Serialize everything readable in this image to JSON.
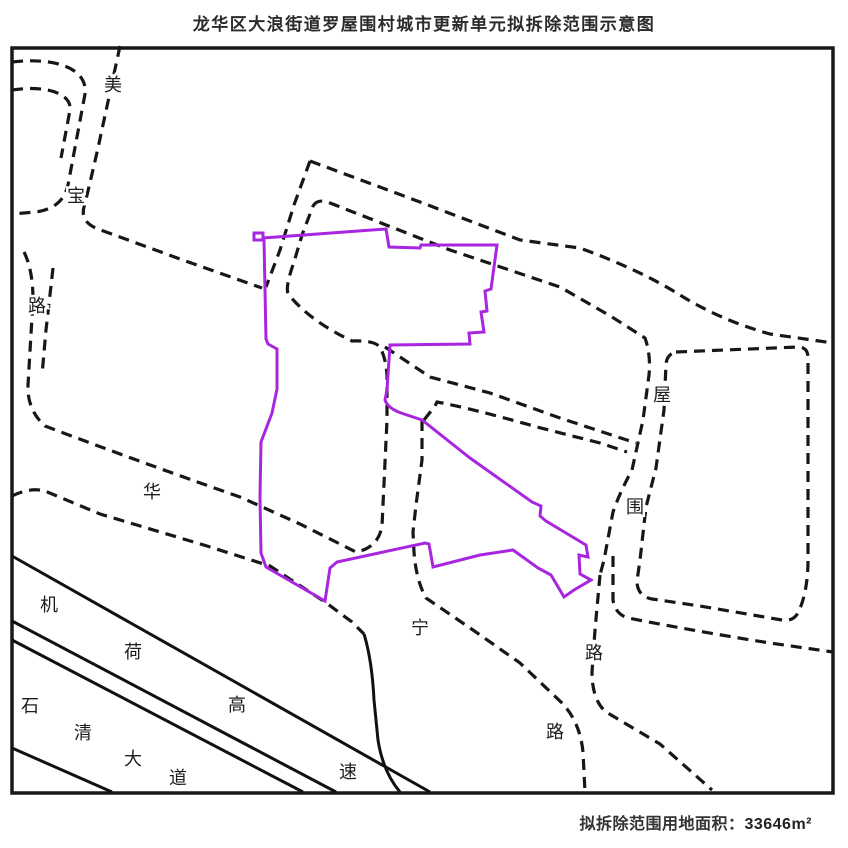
{
  "title": "龙华区大浪街道罗屋围村城市更新单元拟拆除范围示意图",
  "caption": {
    "label": "拟拆除范围用地面积：",
    "value": "33646m²"
  },
  "colors": {
    "ink": "#191919",
    "road_dash": "#171717",
    "solid_road": "#111111",
    "demolition_outline": "#a826df",
    "background": "#ffffff",
    "label_ink": "#1c1c1c"
  },
  "map": {
    "frame": {
      "x": 12,
      "y": 48,
      "width": 821,
      "height": 745
    },
    "dash_pattern": "11 7",
    "demolition_boundary": "M254,240 L254,233 263,233 263,238 386,229 389,247 420,248 421,245 497,245 491,289 485,291 487,311 481,312 484,332 469,333 470,344 390,345 387,390 385,400 Q388,409 404,414 L422,420 470,458 532,502 541,506 540,516 546,521 586,545 588,557 579,555 580,574 591,580 574,590 564,597 551,575 538,568 513,550 480,555 433,567 429,544 425,543 337,562 330,568 325,601 266,567 261,553 260,497 261,442 272,413 277,389 277,349 268,344 266,339 264,240 Z",
    "dashed_roads": [
      {
        "name": "meibao-rd-east-edge",
        "d": "M120,46 L98,148 Q87,196 84,207 Q80,222 98,229 L180,259 262,288"
      },
      {
        "name": "nw-branch-upper",
        "d": "M12,62 C55,57 88,68 85,94 L68,185 Q63,208 36,212 L12,214"
      },
      {
        "name": "nw-branch-lower",
        "d": "M12,90 C45,85 72,93 70,110 L61,158"
      },
      {
        "name": "meibao-south-huaning-north-loop",
        "d": "M24,252 Q33,270 33,300 L28,385 Q27,410 45,426 Q140,462 240,497 L300,524 356,552 Q378,548 382,526 L387,420 387,375 Q386,360 381,349 Q377,340 352,341 Q310,321 289,295 Q284,290 294,262 L302,235 313,206"
      },
      {
        "name": "meibao-south-inner-edge",
        "d": "M53,268 L46,330 42,375"
      },
      {
        "name": "huaning-rd-south-edge",
        "d": "M12,496 Q30,487 45,491 L100,514 207,546 270,566 325,602 352,622 364,634"
      },
      {
        "name": "ne-road-west-branch",
        "d": "M310,161 L294,205 280,250 266,287"
      },
      {
        "name": "ne-road-outer-edge",
        "d": "M310,161 L420,202 520,240 580,248 Q640,270 680,295 Q720,320 770,334 L833,343"
      },
      {
        "name": "ne-road-inner-wuwei-west-edge",
        "d": "M313,206 Q318,198 330,203 L450,250 560,287 612,317 645,338 Q651,355 649,375 L643,420 632,470 Q620,492 613,512 L604,560 600,575"
      },
      {
        "name": "wuwei-rd-lower-west-edge",
        "d": "M600,575 L595,630 592,672 Q592,700 606,712 L660,744 712,790"
      },
      {
        "name": "huaning-rd-ne-edge",
        "d": "M422,420 L422,460 416,505 413,532 L414,552 Q416,580 426,598 L473,630 520,663 562,703 Q580,722 583,752 L585,792"
      },
      {
        "name": "east-parcel-boundary",
        "d": "M676,352 L798,347 Q808,347 808,358 L808,560 Q808,590 799,611 Q794,622 782,620 L700,606 652,599 Q637,596 637,581 L640,560 646,507 656,468 664,410 666,364 Q667,354 676,352 Z"
      },
      {
        "name": "ene-road-south-edge",
        "d": "M613,556 L613,600 Q615,614 628,618 Q700,632 770,643 L833,652"
      },
      {
        "name": "mid-lane-north-edge",
        "d": "M385,347 L430,377 490,393 560,418 636,443"
      },
      {
        "name": "mid-lane-south-edge",
        "d": "M424,420 L435,406 437,402 Q470,408 537,427 L600,443 627,452"
      }
    ],
    "solid_roads": [
      {
        "name": "jihe-expressway-line-1",
        "d": "M12,556 L430,792"
      },
      {
        "name": "jihe-expressway-line-2",
        "d": "M12,621 L336,792"
      },
      {
        "name": "shiqing-avenue-line-1",
        "d": "M12,640 L303,792"
      },
      {
        "name": "shiqing-avenue-line-2",
        "d": "M12,748 L112,792"
      },
      {
        "name": "ramp-curve",
        "d": "M364,634 Q372,660 374,700 L378,740 Q383,772 400,792"
      }
    ],
    "road_labels": [
      {
        "road": "美宝路",
        "chars": [
          {
            "t": "美",
            "x": 113,
            "y": 85
          },
          {
            "t": "宝",
            "x": 76,
            "y": 196
          },
          {
            "t": "路",
            "x": 37,
            "y": 306
          }
        ]
      },
      {
        "road": "华宁路",
        "chars": [
          {
            "t": "华",
            "x": 152,
            "y": 492
          },
          {
            "t": "宁",
            "x": 420,
            "y": 628
          },
          {
            "t": "路",
            "x": 555,
            "y": 732
          }
        ]
      },
      {
        "road": "屋围路",
        "chars": [
          {
            "t": "屋",
            "x": 662,
            "y": 395
          },
          {
            "t": "围",
            "x": 635,
            "y": 507
          },
          {
            "t": "路",
            "x": 594,
            "y": 653
          }
        ]
      },
      {
        "road": "机荷高速",
        "chars": [
          {
            "t": "机",
            "x": 49,
            "y": 605
          },
          {
            "t": "荷",
            "x": 133,
            "y": 652
          },
          {
            "t": "高",
            "x": 237,
            "y": 705
          },
          {
            "t": "速",
            "x": 348,
            "y": 772
          }
        ]
      },
      {
        "road": "石清大道",
        "chars": [
          {
            "t": "石",
            "x": 30,
            "y": 706
          },
          {
            "t": "清",
            "x": 83,
            "y": 733
          },
          {
            "t": "大",
            "x": 133,
            "y": 759
          },
          {
            "t": "道",
            "x": 178,
            "y": 778
          }
        ]
      }
    ]
  }
}
